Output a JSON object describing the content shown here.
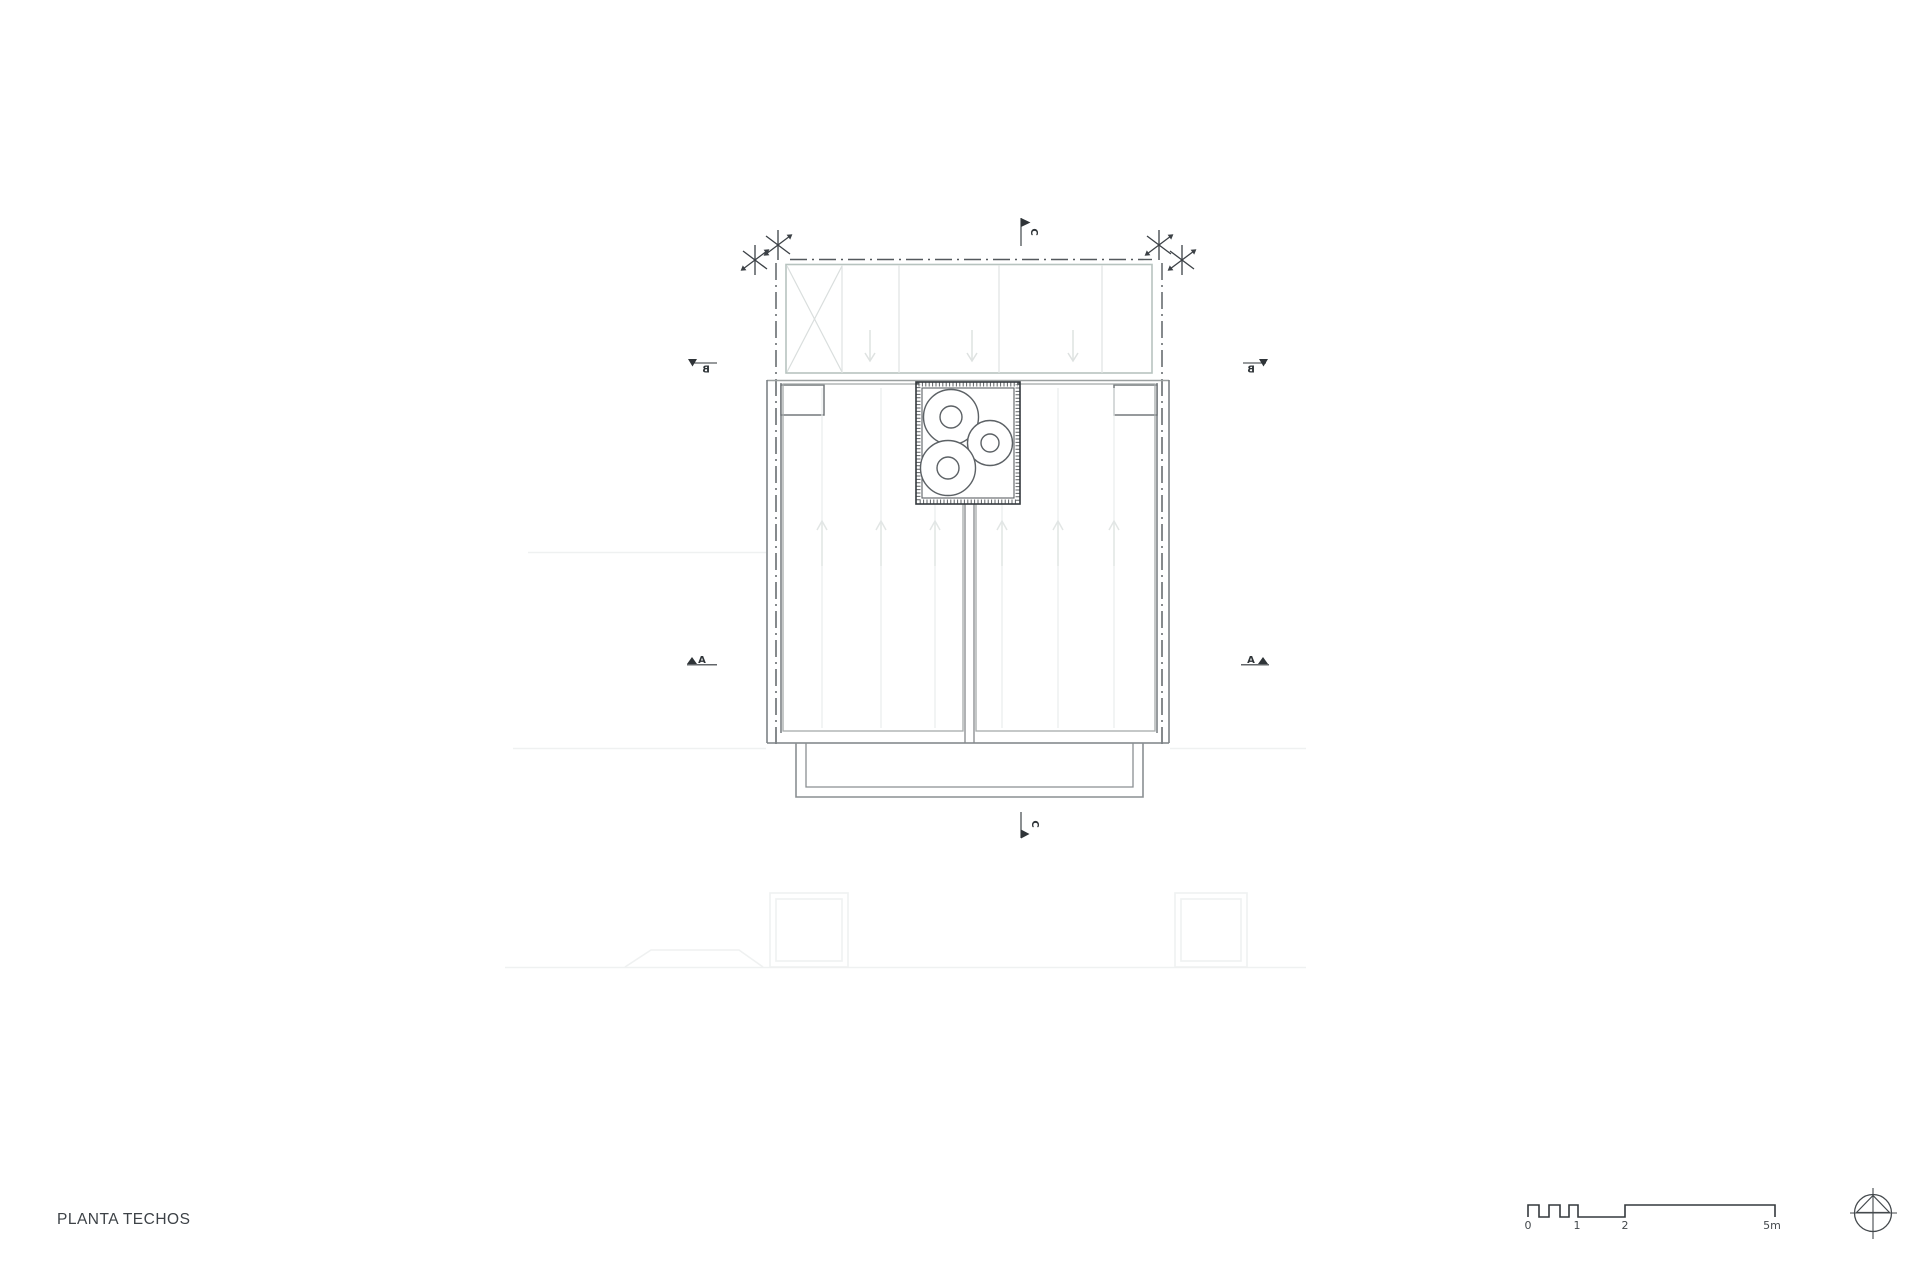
{
  "title": "PLANTA TECHOS",
  "drawing": {
    "type": "architectural-roof-plan",
    "section_markers": {
      "a": "A",
      "b": "B",
      "c": "C"
    },
    "scale_bar": {
      "unit_labels": [
        "0",
        "1",
        "2",
        "5m"
      ]
    },
    "colors": {
      "ink": "#34393d",
      "centerline": "#53585c",
      "wall_gray": "#7d8286",
      "panel_gray": "#a6abab",
      "teal_overhang": "#b7c3bf",
      "bay_line": "#dfe3e2",
      "seam_line": "#eaeded",
      "ghost_line": "#eff1f1",
      "background": "#ffffff"
    }
  }
}
